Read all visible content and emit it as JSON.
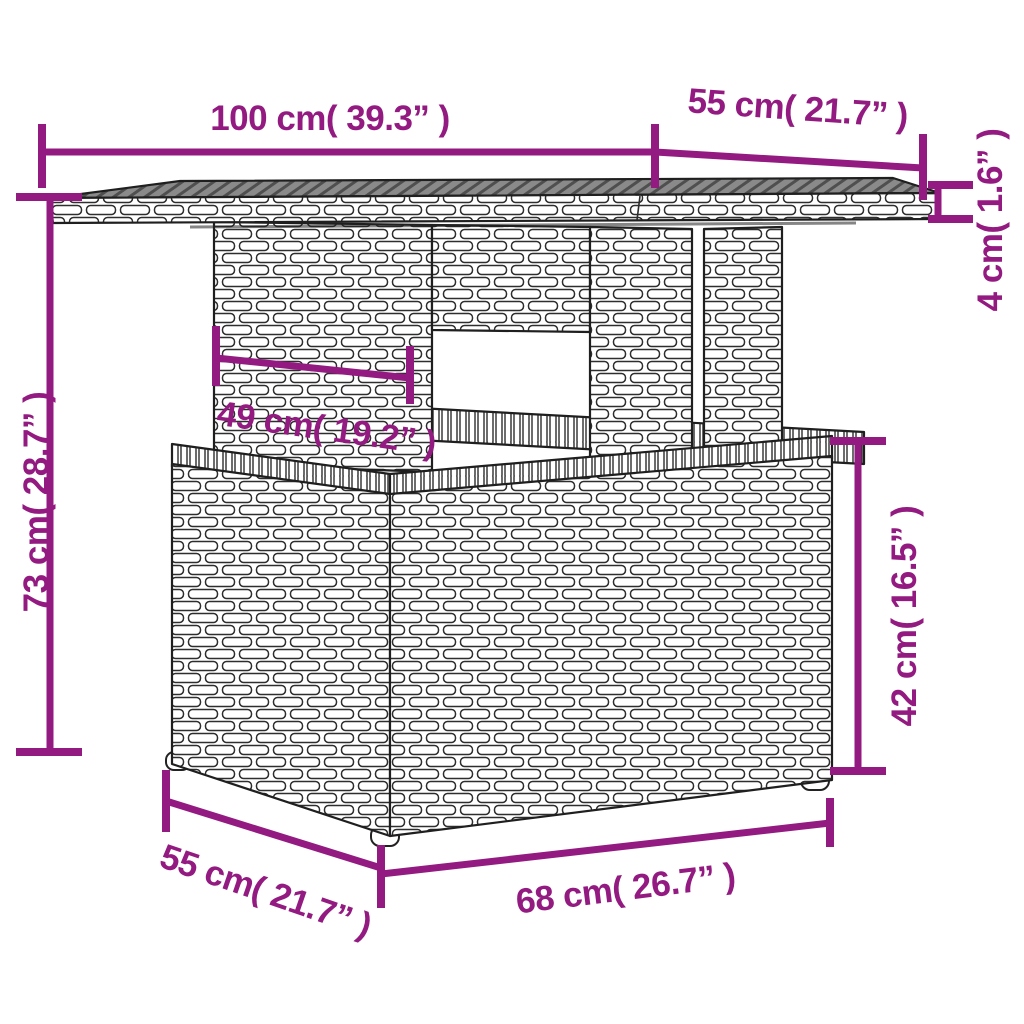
{
  "diagram": {
    "subject": "poly rattan garden table with storage base - dimension drawing",
    "background_color": "#ffffff",
    "accent_color": "#931A80",
    "line_art_color": "#1f1f1f",
    "tabletop_surface_color": "#848484",
    "parts": [
      "tabletop",
      "pedestal with cut-out window",
      "storage base box",
      "feet"
    ]
  },
  "dimensions": {
    "top_length": {
      "label": "100 cm( 39.3” )",
      "cm": 100,
      "inches": 39.3,
      "orientation": "horizontal",
      "measures": "tabletop length (front edge)"
    },
    "top_depth": {
      "label": "55 cm( 21.7” )",
      "cm": 55,
      "inches": 21.7,
      "orientation": "diagonal",
      "measures": "tabletop depth (receding edge)"
    },
    "top_thickness": {
      "label": "4 cm( 1.6” )",
      "cm": 4,
      "inches": 1.6,
      "orientation": "vertical-rotated",
      "measures": "tabletop thickness"
    },
    "overall_height": {
      "label": "73 cm( 28.7” )",
      "cm": 73,
      "inches": 28.7,
      "orientation": "vertical-rotated",
      "measures": "total table height"
    },
    "pedestal_width": {
      "label": "49 cm( 19.2” )",
      "cm": 49,
      "inches": 19.2,
      "orientation": "diagonal",
      "measures": "pedestal panel width"
    },
    "base_height": {
      "label": "42 cm( 16.5” )",
      "cm": 42,
      "inches": 16.5,
      "orientation": "vertical-rotated",
      "measures": "storage base height"
    },
    "base_depth": {
      "label": "55 cm( 21.7” )",
      "cm": 55,
      "inches": 21.7,
      "orientation": "diagonal",
      "measures": "storage base depth (left edge)"
    },
    "base_width": {
      "label": "68 cm( 26.7” )",
      "cm": 68,
      "inches": 26.7,
      "orientation": "diagonal",
      "measures": "storage base front width"
    }
  }
}
